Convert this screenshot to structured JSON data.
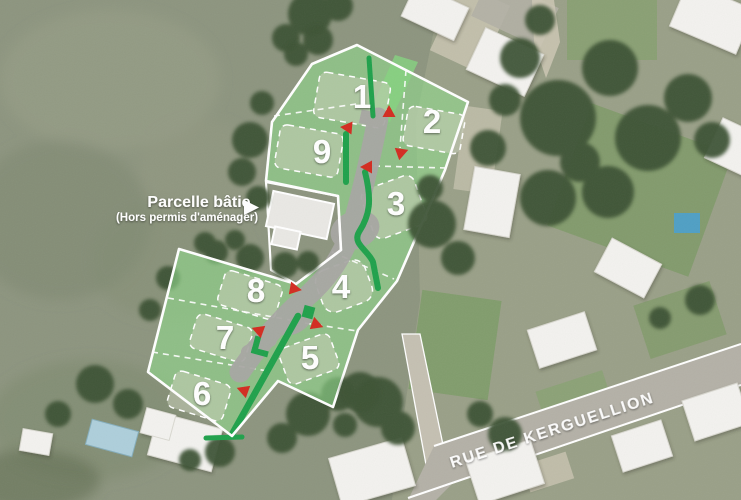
{
  "overlay": {
    "annotation": {
      "title": "Parcelle bâtie",
      "subtitle": "(Hors permis d'aménager)"
    },
    "street_name": "RUE DE KERGUELLION",
    "parcels": [
      {
        "number": "1"
      },
      {
        "number": "2"
      },
      {
        "number": "3"
      },
      {
        "number": "4"
      },
      {
        "number": "5"
      },
      {
        "number": "6"
      },
      {
        "number": "7"
      },
      {
        "number": "8"
      },
      {
        "number": "9"
      }
    ],
    "entry_markers": {
      "count": 8
    },
    "colors": {
      "parcel_fill": "#8fd88a",
      "envelope_fill": "#c6cdb8",
      "hedge": "#1fa14b",
      "road": "#a7a6a3",
      "entry_marker": "#d32b20",
      "boundary": "#ffffff"
    }
  }
}
